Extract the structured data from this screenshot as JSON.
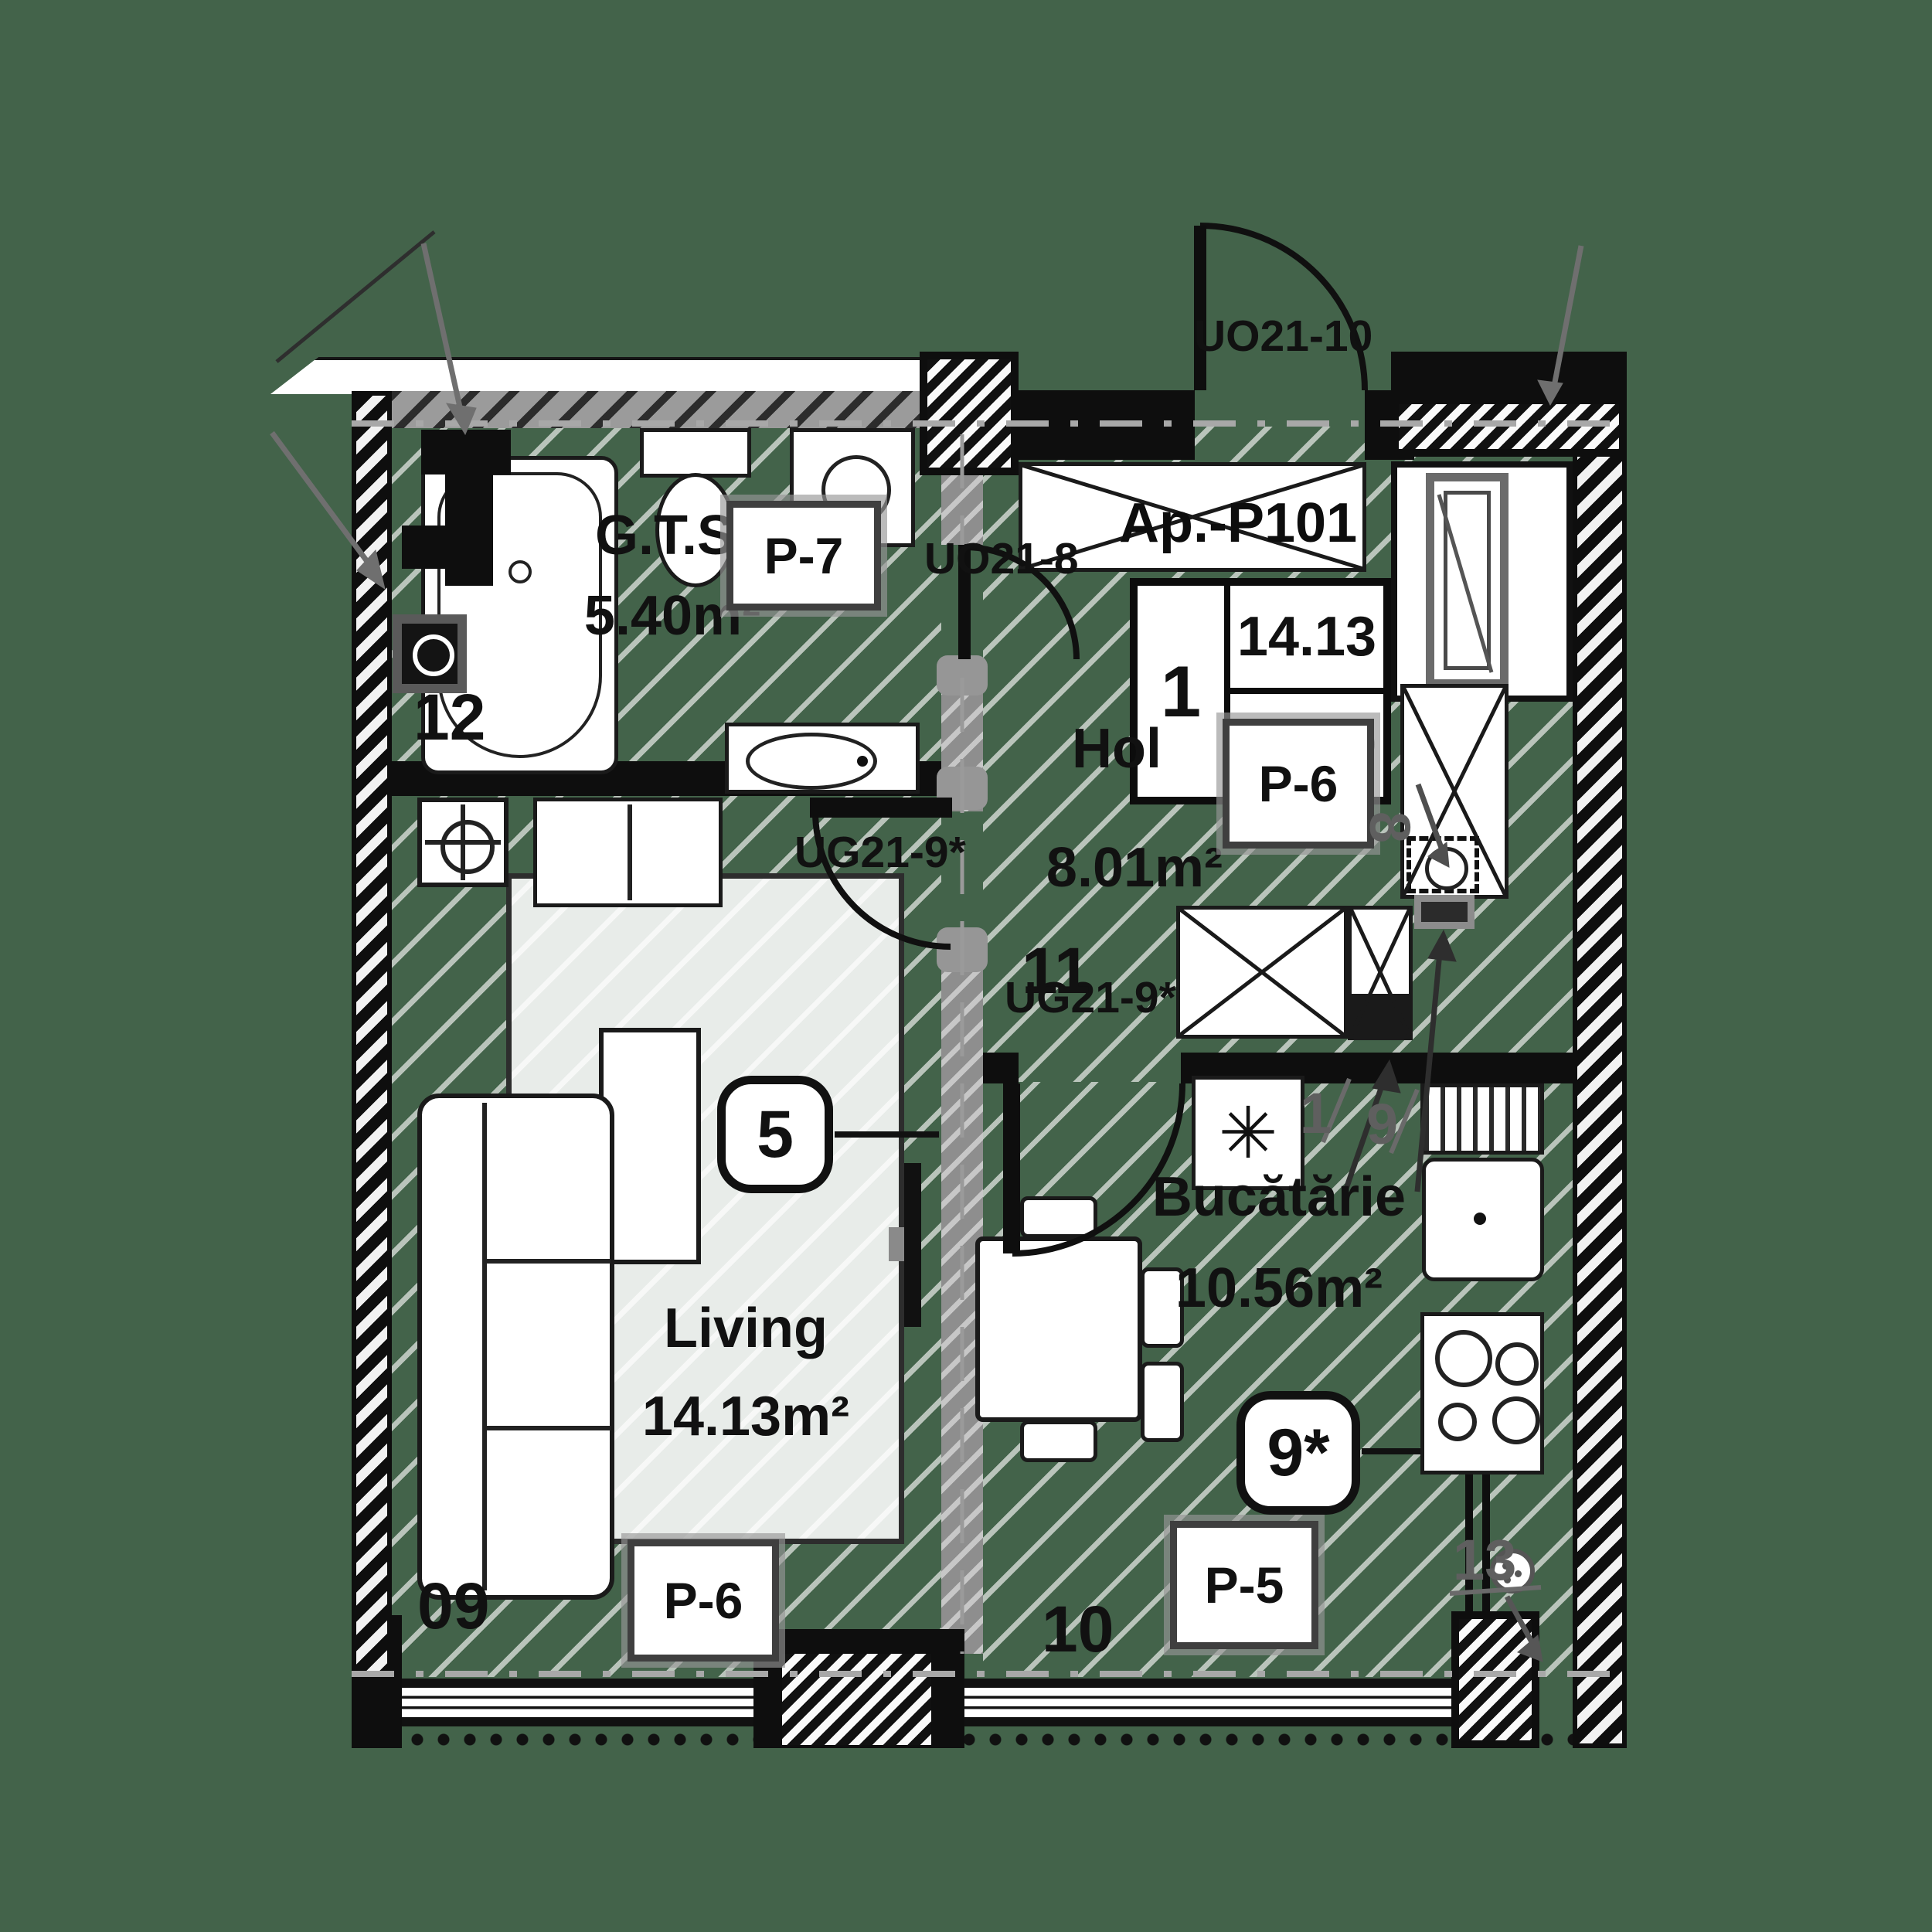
{
  "plan": {
    "apartment_label": "Ap.-P101",
    "info_table": {
      "rooms_count": "1",
      "room_area": "14.13",
      "total_area": "38.09"
    },
    "rooms": {
      "bathroom": {
        "name": "G.T.S.",
        "area": "5.40m²",
        "finish_tag": "P-7",
        "wall_marker": "12"
      },
      "hallway": {
        "name": "Hol",
        "area": "8.01m²",
        "finish_tag": "P-6",
        "wall_marker": "11"
      },
      "living": {
        "name": "Living",
        "area": "14.13m²",
        "finish_tag": "P-6",
        "wall_marker": "09",
        "position_badge": "5"
      },
      "kitchen": {
        "name": "Bucătărie",
        "area": "10.56m²",
        "finish_tag": "P-5",
        "wall_marker": "10",
        "position_badge": "9*"
      }
    },
    "doors": {
      "entrance": "UO21-10",
      "bathroom": "UO21-8",
      "living_partition": "UG21-9*",
      "kitchen_partition": "UG21-9*"
    },
    "ref_markers": {
      "shaft": "8",
      "corner_drain": "13",
      "item_a": "1",
      "item_b": "9"
    },
    "symbols": {
      "ceiling_light": "✳"
    },
    "colors": {
      "background": "#43634a",
      "wall": "#0e0e0e",
      "partition_gray": "#8e8e8e",
      "marker_gray": "#5f5f5f"
    }
  }
}
